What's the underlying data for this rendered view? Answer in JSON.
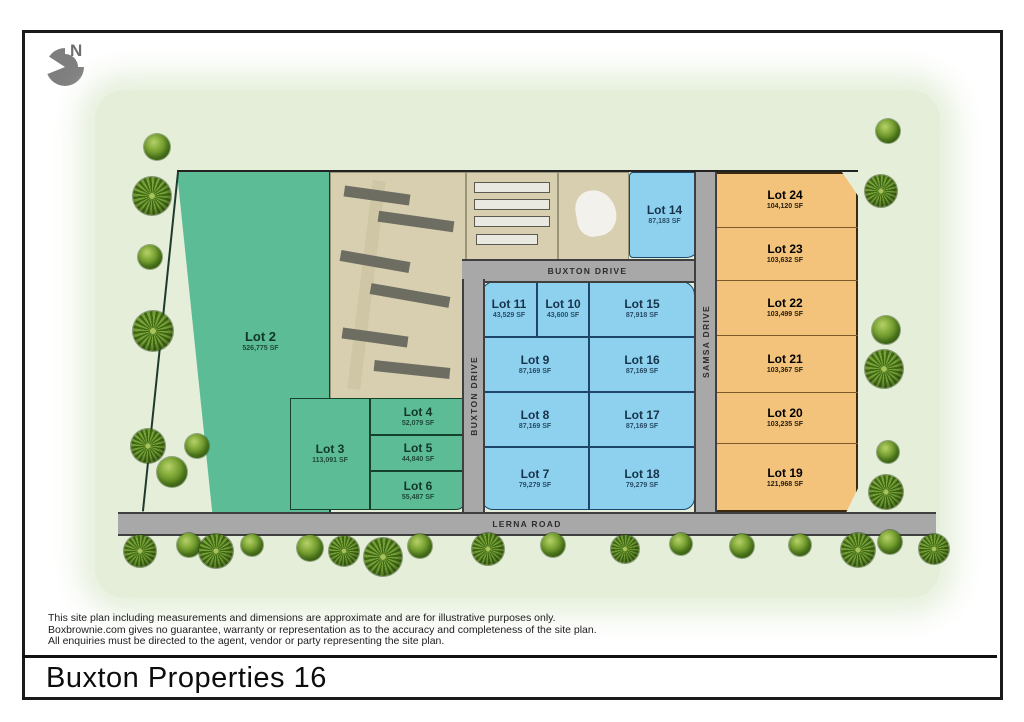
{
  "title": "Buxton Properties 16",
  "north": {
    "label": "N"
  },
  "roads": {
    "buxton_horizontal": "BUXTON DRIVE",
    "buxton_vertical": "BUXTON DRIVE",
    "samsa": "SAMSA DRIVE",
    "lerna": "LERNA ROAD"
  },
  "lots": {
    "lot2": {
      "name": "Lot 2",
      "area": "526,775 SF"
    },
    "lot3": {
      "name": "Lot 3",
      "area": "113,091 SF"
    },
    "lot4": {
      "name": "Lot 4",
      "area": "52,079 SF"
    },
    "lot5": {
      "name": "Lot 5",
      "area": "44,840 SF"
    },
    "lot6": {
      "name": "Lot 6",
      "area": "55,487 SF"
    },
    "lot7": {
      "name": "Lot 7",
      "area": "79,279 SF"
    },
    "lot8": {
      "name": "Lot 8",
      "area": "87,169 SF"
    },
    "lot9": {
      "name": "Lot 9",
      "area": "87,169 SF"
    },
    "lot10": {
      "name": "Lot 10",
      "area": "43,600 SF"
    },
    "lot11": {
      "name": "Lot 11",
      "area": "43,529 SF"
    },
    "lot14": {
      "name": "Lot 14",
      "area": "87,183 SF"
    },
    "lot15": {
      "name": "Lot 15",
      "area": "87,918 SF"
    },
    "lot16": {
      "name": "Lot 16",
      "area": "87,169 SF"
    },
    "lot17": {
      "name": "Lot 17",
      "area": "87,169 SF"
    },
    "lot18": {
      "name": "Lot 18",
      "area": "79,279 SF"
    },
    "lot19": {
      "name": "Lot 19",
      "area": "121,968 SF"
    },
    "lot20": {
      "name": "Lot 20",
      "area": "103,235 SF"
    },
    "lot21": {
      "name": "Lot 21",
      "area": "103,367 SF"
    },
    "lot22": {
      "name": "Lot 22",
      "area": "103,499 SF"
    },
    "lot23": {
      "name": "Lot 23",
      "area": "103,632 SF"
    },
    "lot24": {
      "name": "Lot 24",
      "area": "104,120 SF"
    }
  },
  "disclaimer": {
    "line1": "This site plan including measurements and dimensions are approximate and are for illustrative purposes only.",
    "line2": "Boxbrownie.com gives no guarantee, warranty or representation as to the accuracy and completeness of the site plan.",
    "line3": "All enquiries must be directed to the agent, vendor or party representing the site plan."
  },
  "colors": {
    "green_lot": "#5cbc95",
    "blue_lot": "#8ed1ef",
    "orange_lot": "#f3c37c",
    "road": "#a8a8a8",
    "site_background": "#e4eed9"
  }
}
